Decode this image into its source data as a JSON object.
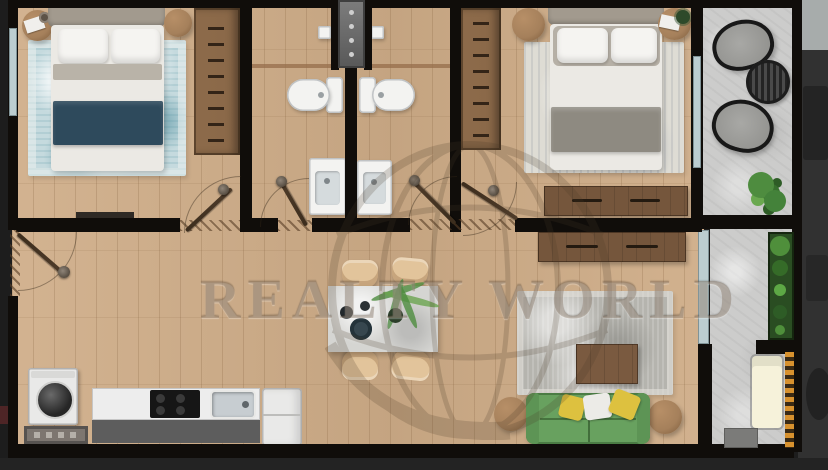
{
  "scene": {
    "description": "Top-down 3D rendered two-bedroom apartment floor plan photo",
    "rooms": [
      "bedroom-left",
      "bathroom-1",
      "bathroom-2",
      "bedroom-right",
      "living-dining-kitchen",
      "balcony-upper",
      "balcony-lower"
    ]
  },
  "watermark": {
    "text": "REALTY WORLD",
    "logo": "globe-watermark"
  },
  "palette": {
    "wall": "#100d0a",
    "wood": "#cfad88",
    "wood_line": "rgba(125,90,55,0.22)",
    "wood_line_soft": "rgba(125,90,55,0.12)",
    "concrete": "#cccccb",
    "outside_left": "#1d1d1d",
    "outside_right": "#313131",
    "outside_corner": "#a7acab",
    "bottom_strip": "#232323",
    "window": "#bccdd0",
    "shaft_dark": "#585858",
    "shaft_light": "#7d7d7d",
    "rug_blue": "#c5dade",
    "rug_light": "#dedcd4",
    "rug_gray": "#b5b4ae",
    "bed_white": "#ebe9e4",
    "pillow_white": "#f5f4f1",
    "headboard": "#a29a8e",
    "blanket_teal": "#2e4a5c",
    "blanket_gray": "#8e8a81",
    "wood_dark": "#75563c",
    "wardrobe": "#8a6848",
    "wardrobe_tick": "#332417",
    "pouf_brown": "#a5805b",
    "fixture_white": "#f3f3f1",
    "basin_gray": "#d5dbdd",
    "counter_white": "#ededed",
    "counter_base": "#5d5d5d",
    "cooktop_black": "#161616",
    "steel": "#c7cdd1",
    "fridge_white": "#e9e9e8",
    "sofa_green": "#68a15f",
    "pillow_yellow": "#ddc13f",
    "chair_beige": "#e2c49b",
    "table_gray": "#d5d5d2",
    "coffee_wood": "#7a5a40",
    "planter_green_dark": "#2a4d22",
    "plant_green": "#4e8c3f",
    "accent_orange": "#d7912e",
    "mat_gray": "#7d7670",
    "door_wood": "#4f3c2a",
    "watermark_ink": "rgba(105,83,58,0.30)",
    "globe_ink": "#4a3a28"
  }
}
